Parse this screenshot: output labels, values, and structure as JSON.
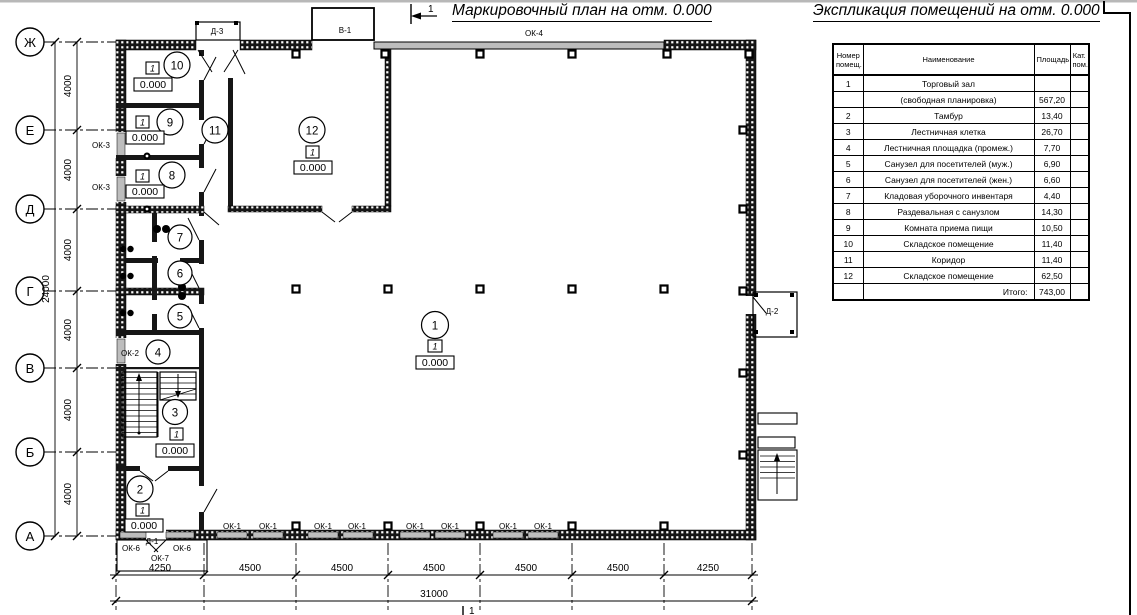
{
  "titles": {
    "plan": "Маркировочный план на отм. 0.000",
    "explication": "Экспликация помещений на отм. 0.000"
  },
  "section": {
    "number": "1"
  },
  "axes": {
    "letters": [
      "Ж",
      "Е",
      "Д",
      "Г",
      "В",
      "Б",
      "А"
    ]
  },
  "dims": {
    "left": [
      "4000",
      "4000",
      "4000",
      "4000",
      "4000",
      "4000"
    ],
    "left_total": "24000",
    "bottom": [
      "4250",
      "4500",
      "4500",
      "4500",
      "4500",
      "4500",
      "4250"
    ],
    "bottom_total": "31000"
  },
  "openings": {
    "ok1": "ОК-1",
    "ok2": "ОК-2",
    "ok3": "ОК-3",
    "ok4": "ОК-4",
    "ok6": "ОК-6",
    "ok7": "ОК-7",
    "d1": "Д-1",
    "d2": "Д-2",
    "d3": "Д-3",
    "v1": "В-1"
  },
  "rooms": [
    {
      "num": "1",
      "marker": "1",
      "elev": "0.000"
    },
    {
      "num": "2",
      "marker": "1",
      "elev": "0.000"
    },
    {
      "num": "3",
      "marker": "1",
      "elev": "0.000"
    },
    {
      "num": "4"
    },
    {
      "num": "5"
    },
    {
      "num": "6"
    },
    {
      "num": "7"
    },
    {
      "num": "8",
      "marker": "1",
      "elev": "0.000"
    },
    {
      "num": "9",
      "marker": "1",
      "elev": "0.000"
    },
    {
      "num": "10",
      "marker": "1",
      "elev": "0.000"
    },
    {
      "num": "11"
    },
    {
      "num": "12",
      "marker": "1",
      "elev": "0.000"
    }
  ],
  "explication_table": {
    "headers": {
      "num": "Номер помещ.",
      "name": "Наименование",
      "area": "Площадь",
      "cat": "Кат. пом."
    },
    "rows": [
      {
        "num": "1",
        "name": "Торговый зал",
        "area": "",
        "cat": ""
      },
      {
        "num": "",
        "name": "(свободная планировка)",
        "area": "567,20",
        "cat": ""
      },
      {
        "num": "2",
        "name": "Тамбур",
        "area": "13,40",
        "cat": ""
      },
      {
        "num": "3",
        "name": "Лестничная клетка",
        "area": "26,70",
        "cat": ""
      },
      {
        "num": "4",
        "name": "Лестничная площадка (промеж.)",
        "area": "7,70",
        "cat": ""
      },
      {
        "num": "5",
        "name": "Санузел для посетителей (муж.)",
        "area": "6,90",
        "cat": ""
      },
      {
        "num": "6",
        "name": "Санузел для посетителей (жен.)",
        "area": "6,60",
        "cat": ""
      },
      {
        "num": "7",
        "name": "Кладовая уборочного инвентаря",
        "area": "4,40",
        "cat": ""
      },
      {
        "num": "8",
        "name": "Раздевальная с санузлом",
        "area": "14,30",
        "cat": ""
      },
      {
        "num": "9",
        "name": "Комната приема пищи",
        "area": "10,50",
        "cat": ""
      },
      {
        "num": "10",
        "name": "Складское помещение",
        "area": "11,40",
        "cat": ""
      },
      {
        "num": "11",
        "name": "Коридор",
        "area": "11,40",
        "cat": ""
      },
      {
        "num": "12",
        "name": "Складское помещение",
        "area": "62,50",
        "cat": ""
      },
      {
        "num": "",
        "name": "Итого:",
        "area": "743,00",
        "cat": ""
      }
    ]
  }
}
